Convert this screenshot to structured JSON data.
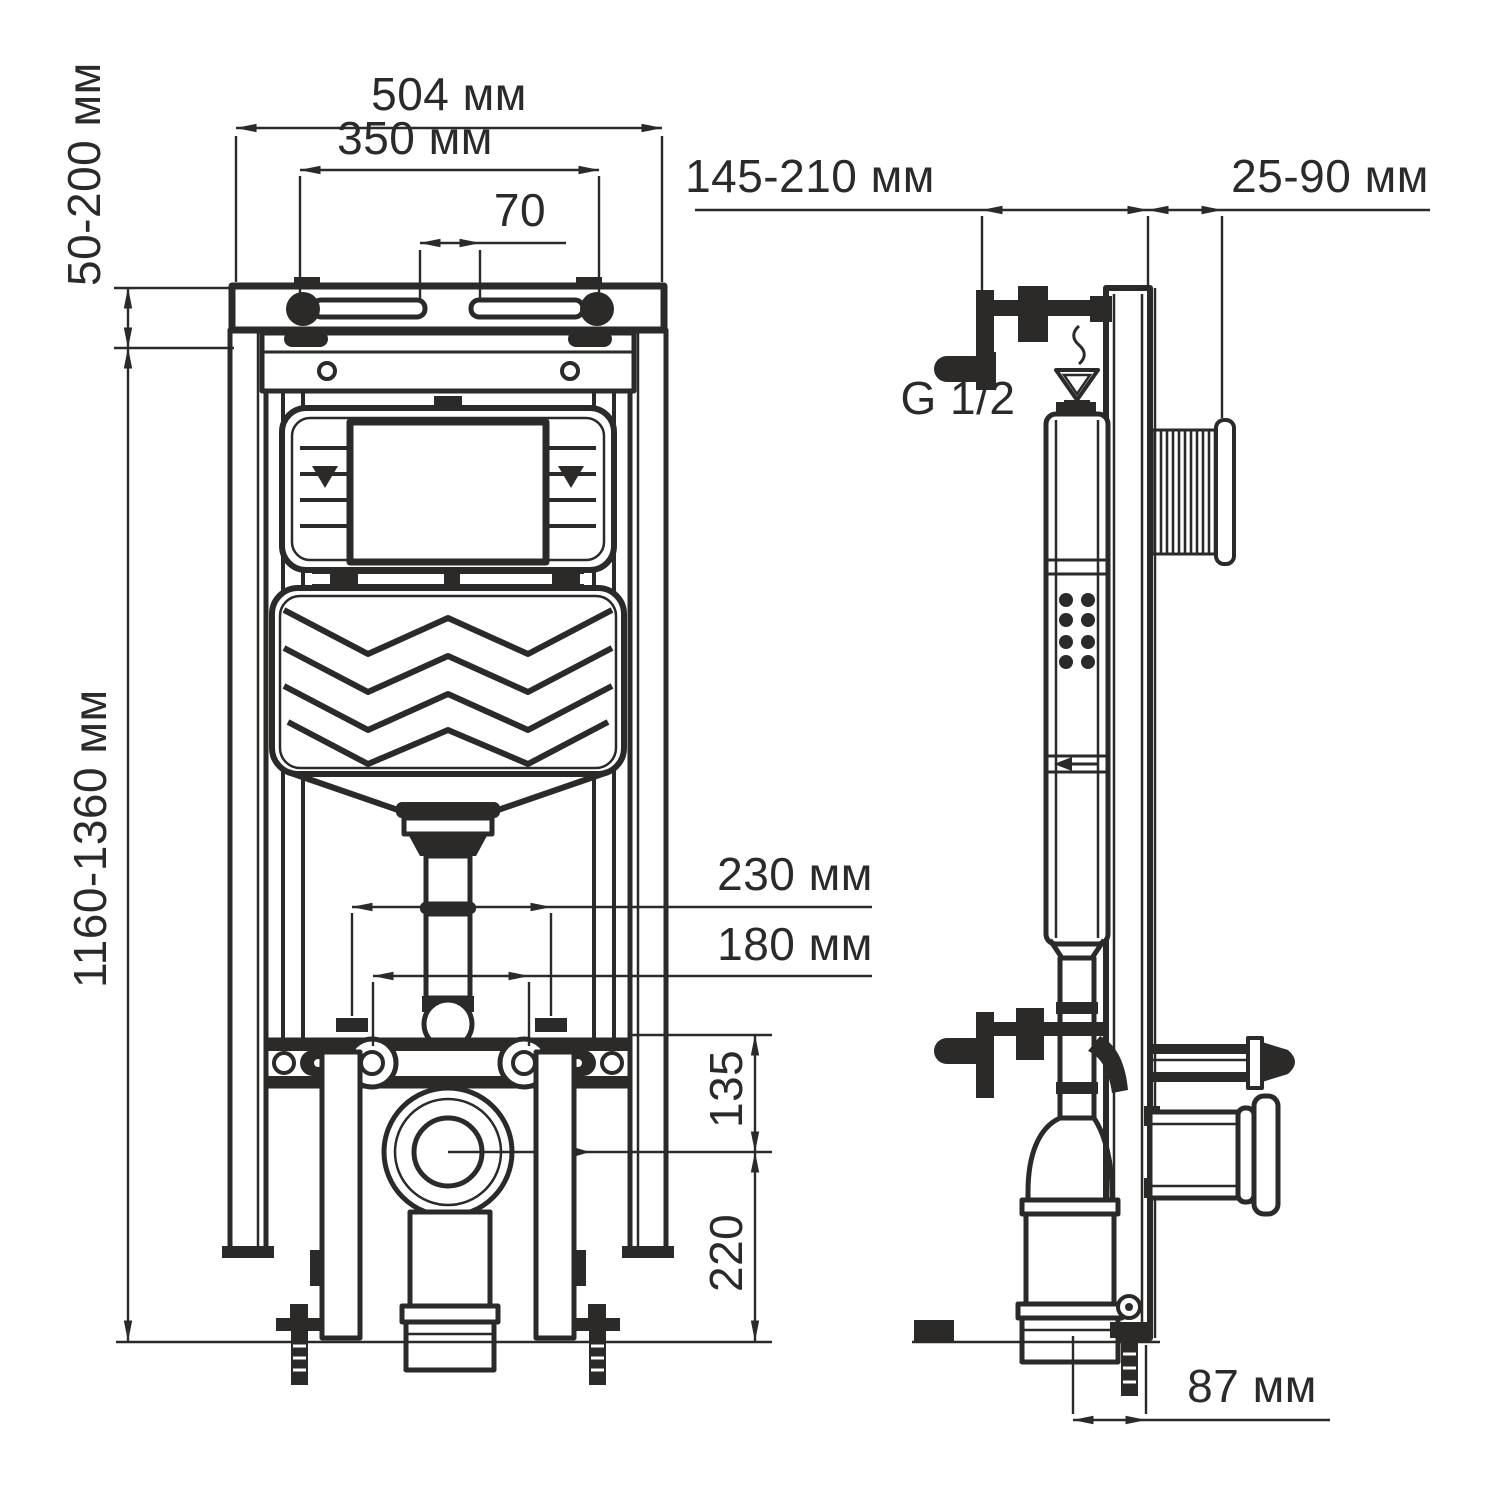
{
  "colors": {
    "line": "#2b2a29",
    "background": "#ffffff"
  },
  "dims": {
    "frame_width": "504 мм",
    "hanger_spacing": "350 мм",
    "slot_offset": "70",
    "top_adjust": "50-200 мм",
    "frame_height": "1160-1360 мм",
    "depth_adjust": "145-210 мм",
    "button_depth": "25-90 мм",
    "inlet_thread": "G 1/2",
    "stud_spacing_outer": "230 мм",
    "stud_spacing_inner": "180 мм",
    "waste_center": "135",
    "waste_drop": "220",
    "drain_offset": "87 мм"
  }
}
